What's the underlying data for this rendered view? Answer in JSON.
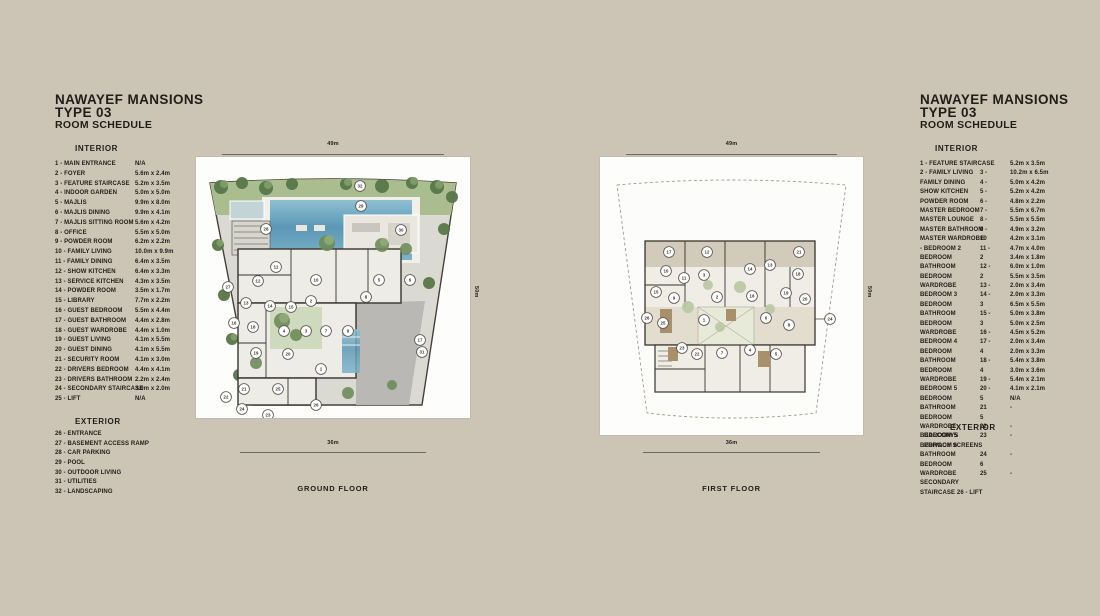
{
  "page": {
    "bg": "#ccc5b6",
    "text_color": "#201d18"
  },
  "left_panel": {
    "title_line1": "NAWAYEF MANSIONS",
    "title_line2": "TYPE 03",
    "title_line3": "ROOM SCHEDULE",
    "interior_heading": "INTERIOR",
    "interior_items": [
      {
        "label": "1 -  MAIN ENTRANCE",
        "size": "N/A"
      },
      {
        "label": "2 -  FOYER",
        "size": "5.6m x 2.4m"
      },
      {
        "label": "3 -  FEATURE STAIRCASE",
        "size": "5.2m x 3.5m"
      },
      {
        "label": "4 -  INDOOR GARDEN",
        "size": "5.0m x 5.0m"
      },
      {
        "label": "5 -  MAJLIS",
        "size": "9.9m x 8.0m"
      },
      {
        "label": "6 -  MAJLIS DINING",
        "size": "9.9m x 4.1m"
      },
      {
        "label": "7 -  MAJLIS SITTING ROOM",
        "size": "5.6m x 4.2m"
      },
      {
        "label": "8 -  OFFICE",
        "size": "5.5m x 5.0m"
      },
      {
        "label": "9 -  POWDER ROOM",
        "size": "6.2m x 2.2m"
      },
      {
        "label": "10 - FAMILY LIVING",
        "size": "10.0m x 9.9m"
      },
      {
        "label": "11 - FAMILY DINING",
        "size": "6.4m x 3.5m"
      },
      {
        "label": "12 - SHOW KITCHEN",
        "size": "6.4m x 3.3m"
      },
      {
        "label": "13 - SERVICE KITCHEN",
        "size": "4.3m x 3.5m"
      },
      {
        "label": "14 - POWDER ROOM",
        "size": "3.5m x 1.7m"
      },
      {
        "label": "15 - LIBRARY",
        "size": "7.7m x 2.2m"
      },
      {
        "label": "16 - GUEST BEDROOM",
        "size": "5.5m x 4.4m"
      },
      {
        "label": "17 - GUEST BATHROOM",
        "size": "4.4m x 2.8m"
      },
      {
        "label": "18 - GUEST WARDROBE",
        "size": "4.4m x 1.0m"
      },
      {
        "label": "19 - GUEST LIVING",
        "size": "4.1m x 5.5m"
      },
      {
        "label": "20 - GUEST DINING",
        "size": "4.1m x 5.5m"
      },
      {
        "label": "21 - SECURITY ROOM",
        "size": "4.1m x 3.0m"
      },
      {
        "label": "22 - DRIVERS BEDROOM",
        "size": "4.4m x 4.1m"
      },
      {
        "label": "23 - DRIVERS BATHROOM",
        "size": "2.2m x 2.4m"
      },
      {
        "label": "24 - SECONDARY STAIRCASE",
        "size": "3.0m x 2.0m"
      },
      {
        "label": "25 - LIFT",
        "size": "N/A"
      }
    ],
    "exterior_heading": "EXTERIOR",
    "exterior_items": [
      "26 - ENTRANCE",
      "27 - BASEMENT ACCESS RAMP",
      "28 - CAR PARKING",
      "29 - POOL",
      "30 - OUTDOOR LIVING",
      "31 - UTILITIES",
      "32 - LANDSCAPING"
    ]
  },
  "right_panel": {
    "title_line1": "NAWAYEF MANSIONS",
    "title_line2": "TYPE 03",
    "title_line3": "ROOM SCHEDULE",
    "interior_heading": "INTERIOR",
    "interior_rows": [
      {
        "a": "1 -  FEATURE STAIRCASE",
        "b": "",
        "c": "5.2m x 3.5m"
      },
      {
        "a": "2 -  FAMILY LIVING",
        "b": "3 -",
        "c": "10.2m x 6.5m"
      },
      {
        "a": "FAMILY DINING",
        "b": "4 -",
        "c": "5.0m x 4.2m"
      },
      {
        "a": "SHOW KITCHEN",
        "b": "5 -",
        "c": "5.2m x 4.2m"
      },
      {
        "a": "POWDER ROOM",
        "b": "6 -",
        "c": "4.8m x 2.2m"
      },
      {
        "a": "MASTER BEDROOM",
        "b": "7 -",
        "c": "5.5m x 6.7m"
      },
      {
        "a": "MASTER LOUNGE",
        "b": "8 -",
        "c": "5.5m x 5.5m"
      },
      {
        "a": "MASTER BATHROOM",
        "b": "9 -",
        "c": "4.9m x 3.2m"
      },
      {
        "a": "MASTER WARDROBE",
        "b": "10",
        "c": "4.2m x 3.1m"
      },
      {
        "a": "-  BEDROOM  2",
        "b": "11 -",
        "c": "4.7m x 4.0m"
      },
      {
        "a": "BEDROOM",
        "b": "2",
        "c": "3.4m x 1.8m"
      },
      {
        "a": "BATHROOM",
        "b": "12 -",
        "c": "6.0m x 1.0m"
      },
      {
        "a": "BEDROOM",
        "b": "2",
        "c": "5.5m x 3.5m"
      },
      {
        "a": "WARDROBE",
        "b": "13 -",
        "c": "2.0m x 3.4m"
      },
      {
        "a": "BEDROOM  3",
        "b": "14 -",
        "c": "2.0m x 3.3m"
      },
      {
        "a": "BEDROOM",
        "b": "3",
        "c": "6.5m x 5.5m"
      },
      {
        "a": "BATHROOM",
        "b": "15 -",
        "c": "5.0m x 3.8m"
      },
      {
        "a": "BEDROOM",
        "b": "3",
        "c": "5.0m x 2.5m"
      },
      {
        "a": "WARDROBE",
        "b": "16 -",
        "c": "4.5m x 5.2m"
      },
      {
        "a": "BEDROOM  4",
        "b": "17 -",
        "c": "2.0m x 3.4m"
      },
      {
        "a": "BEDROOM",
        "b": "4",
        "c": "2.0m x 3.3m"
      },
      {
        "a": "BATHROOM",
        "b": "18 -",
        "c": "5.4m x 3.8m"
      },
      {
        "a": "BEDROOM",
        "b": "4",
        "c": "3.0m x 3.6m"
      },
      {
        "a": "WARDROBE",
        "b": "19 -",
        "c": "5.4m x 2.1m"
      },
      {
        "a": "BEDROOM  5",
        "b": "20 -",
        "c": "4.1m x 2.1m"
      },
      {
        "a": "BEDROOM",
        "b": "5",
        "c": "N/A"
      },
      {
        "a": "BATHROOM",
        "b": "21",
        "c": "-"
      },
      {
        "a": "BEDROOM",
        "b": "5",
        "c": ""
      },
      {
        "a": "WARDROBE",
        "b": "22",
        "c": "-"
      },
      {
        "a": "BEDROOM  5",
        "b": "23",
        "c": "-"
      },
      {
        "a": "BEDROOM  6",
        "b": "",
        "c": ""
      },
      {
        "a": "BATHROOM",
        "b": "24",
        "c": "-"
      },
      {
        "a": "BEDROOM",
        "b": "6",
        "c": ""
      },
      {
        "a": "WARDROBE",
        "b": "25",
        "c": "-"
      },
      {
        "a": "SECONDARY",
        "b": "",
        "c": ""
      },
      {
        "a": "STAIRCASE 26 - LIFT",
        "b": "",
        "c": ""
      }
    ],
    "exterior_overlay": {
      "heading": "EXTERIOR",
      "line1": "BALCONYS",
      "line2": "PRIVACY SCREENS"
    }
  },
  "ground_floor": {
    "label": "GROUND FLOOR",
    "dim_top": "49m",
    "dim_bottom": "36m",
    "dim_side": "50m",
    "markers": [
      {
        "n": 32,
        "x": 164,
        "y": 29
      },
      {
        "n": 29,
        "x": 165,
        "y": 49
      },
      {
        "n": 28,
        "x": 70,
        "y": 72
      },
      {
        "n": 30,
        "x": 205,
        "y": 73
      },
      {
        "n": 27,
        "x": 32,
        "y": 130
      },
      {
        "n": 11,
        "x": 80,
        "y": 110
      },
      {
        "n": 12,
        "x": 62,
        "y": 124
      },
      {
        "n": 10,
        "x": 120,
        "y": 123
      },
      {
        "n": 5,
        "x": 183,
        "y": 123
      },
      {
        "n": 6,
        "x": 214,
        "y": 123
      },
      {
        "n": 13,
        "x": 50,
        "y": 146
      },
      {
        "n": 14,
        "x": 74,
        "y": 149
      },
      {
        "n": 15,
        "x": 95,
        "y": 150
      },
      {
        "n": 2,
        "x": 115,
        "y": 144
      },
      {
        "n": 8,
        "x": 170,
        "y": 140
      },
      {
        "n": 17,
        "x": 224,
        "y": 183
      },
      {
        "n": 16,
        "x": 38,
        "y": 166
      },
      {
        "n": 18,
        "x": 57,
        "y": 170
      },
      {
        "n": 4,
        "x": 88,
        "y": 174
      },
      {
        "n": 3,
        "x": 110,
        "y": 174
      },
      {
        "n": 7,
        "x": 130,
        "y": 174
      },
      {
        "n": 9,
        "x": 152,
        "y": 174
      },
      {
        "n": 19,
        "x": 60,
        "y": 196
      },
      {
        "n": 20,
        "x": 92,
        "y": 197
      },
      {
        "n": 1,
        "x": 125,
        "y": 212
      },
      {
        "n": 31,
        "x": 226,
        "y": 195
      },
      {
        "n": 21,
        "x": 48,
        "y": 232
      },
      {
        "n": 25,
        "x": 82,
        "y": 232
      },
      {
        "n": 26,
        "x": 120,
        "y": 248
      },
      {
        "n": 22,
        "x": 30,
        "y": 240
      },
      {
        "n": 24,
        "x": 46,
        "y": 252
      },
      {
        "n": 23,
        "x": 72,
        "y": 258
      }
    ]
  },
  "first_floor": {
    "label": "FIRST FLOOR",
    "dim_top": "49m",
    "dim_bottom": "36m",
    "dim_side": "50m",
    "markers": [
      {
        "n": 17,
        "x": 69,
        "y": 95
      },
      {
        "n": 12,
        "x": 107,
        "y": 95
      },
      {
        "n": 21,
        "x": 199,
        "y": 95
      },
      {
        "n": 10,
        "x": 66,
        "y": 114
      },
      {
        "n": 11,
        "x": 84,
        "y": 121
      },
      {
        "n": 3,
        "x": 104,
        "y": 118
      },
      {
        "n": 14,
        "x": 150,
        "y": 112
      },
      {
        "n": 13,
        "x": 170,
        "y": 108
      },
      {
        "n": 18,
        "x": 198,
        "y": 117
      },
      {
        "n": 15,
        "x": 56,
        "y": 135
      },
      {
        "n": 9,
        "x": 74,
        "y": 141
      },
      {
        "n": 2,
        "x": 117,
        "y": 140
      },
      {
        "n": 16,
        "x": 152,
        "y": 139
      },
      {
        "n": 19,
        "x": 186,
        "y": 136
      },
      {
        "n": 20,
        "x": 205,
        "y": 142
      },
      {
        "n": 26,
        "x": 47,
        "y": 161
      },
      {
        "n": 25,
        "x": 63,
        "y": 166
      },
      {
        "n": 1,
        "x": 104,
        "y": 163
      },
      {
        "n": 6,
        "x": 166,
        "y": 161
      },
      {
        "n": 8,
        "x": 189,
        "y": 168
      },
      {
        "n": 24,
        "x": 230,
        "y": 162
      },
      {
        "n": 23,
        "x": 82,
        "y": 191
      },
      {
        "n": 22,
        "x": 97,
        "y": 197
      },
      {
        "n": 7,
        "x": 122,
        "y": 196
      },
      {
        "n": 4,
        "x": 150,
        "y": 193
      },
      {
        "n": 5,
        "x": 176,
        "y": 197
      }
    ]
  }
}
